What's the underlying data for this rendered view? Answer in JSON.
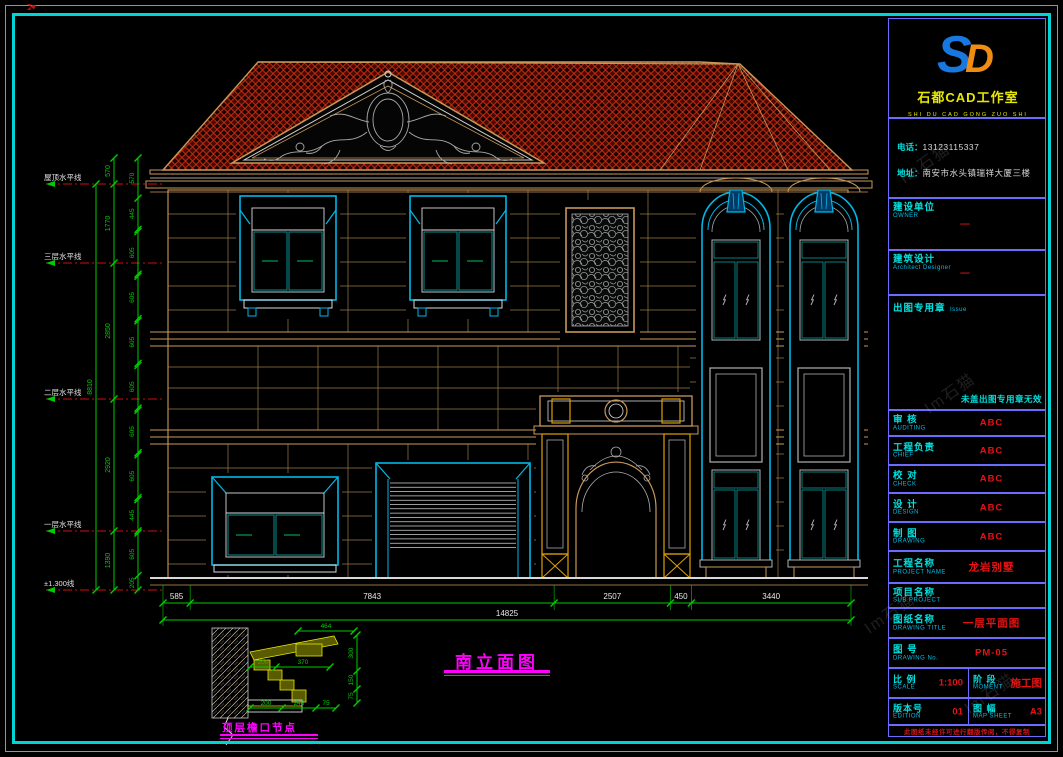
{
  "colors": {
    "border_cyan": "#00d4d4",
    "table_line_blue": "#6b6bff",
    "label_cyan": "#00e0e0",
    "value_red": "#e61212",
    "dim_green": "#00cc00",
    "stone_tan": "#c89858",
    "window_cyan": "#00b8e8",
    "roof_red": "#d83214",
    "title_magenta": "#ff00ff",
    "logo_yellow": "#e8e800"
  },
  "watermark": "Im石猫",
  "title_block": {
    "logo_s": "S",
    "logo_d": "D",
    "company": "石都CAD工作室",
    "company_pinyin": "SHI DU CAD GONG ZUO SHI",
    "phone_label": "电话：",
    "phone": "13123115337",
    "addr_label": "地址：",
    "address": "南安市水头镇瑞祥大厦三楼",
    "owner_label": "建设单位",
    "owner_en": "OWNER",
    "owner_value": "—",
    "designer_label": "建筑设计",
    "designer_en": "Architect Designer",
    "designer_value": "—",
    "seal_label": "出图专用章",
    "seal_en": "Issue",
    "seal_note": "未盖出图专用章无效",
    "rows": [
      {
        "label": "审 核",
        "en": "AUDITING",
        "value": "ABC"
      },
      {
        "label": "工程负责",
        "en": "CHIEF",
        "value": "ABC"
      },
      {
        "label": "校 对",
        "en": "CHECK",
        "value": "ABC"
      },
      {
        "label": "设 计",
        "en": "DESIGN",
        "value": "ABC"
      },
      {
        "label": "制 图",
        "en": "DRAWING",
        "value": "ABC"
      },
      {
        "label": "工程名称",
        "en": "PROJECT NAME",
        "value": "龙岩别墅"
      },
      {
        "label": "项目名称",
        "en": "SUB PROJECT",
        "value": ""
      },
      {
        "label": "图纸名称",
        "en": "DRAWING TITLE",
        "value": "一层平面图"
      },
      {
        "label": "图 号",
        "en": "DRAWING No.",
        "value": "PM-05"
      }
    ],
    "scale_label": "比 例",
    "scale_en": "SCALE",
    "scale_value": "1:100",
    "stage_label": "阶 段",
    "stage_en": "MOMENT",
    "stage_value": "施工图",
    "edition_label": "版本号",
    "edition_en": "EDITION",
    "edition_value": "01",
    "sheet_label": "图 幅",
    "sheet_en": "MAP SHEET",
    "sheet_value": "A3",
    "disclaimer": "此图纸未经许可进行翻版传阅，不得复制"
  },
  "drawing": {
    "title": "南立面图",
    "levels": [
      "屋顶水平线",
      "三层水平线",
      "二层水平线",
      "一层水平线",
      "±1.300线"
    ],
    "v_dim_total": "8810",
    "v_dims_main": [
      "570",
      "1770",
      "2850",
      "2920",
      "1390"
    ],
    "v_dims_small": [
      "570",
      "445",
      "5",
      "605",
      "5",
      "605",
      "5",
      "605",
      "5",
      "605",
      "5",
      "605",
      "5",
      "605",
      "5",
      "445",
      "5",
      "605",
      "205"
    ],
    "h_dims": [
      "585",
      "7843",
      "2507",
      "450",
      "3440"
    ],
    "h_dim_total": "14825",
    "detail": {
      "label": "顶层檐口节点",
      "dim_top": "464",
      "dims_right": [
        "300",
        "150",
        "75"
      ],
      "dims_mid": [
        "200",
        "370"
      ],
      "dims_bottom": [
        "200",
        "245",
        "75"
      ]
    }
  }
}
